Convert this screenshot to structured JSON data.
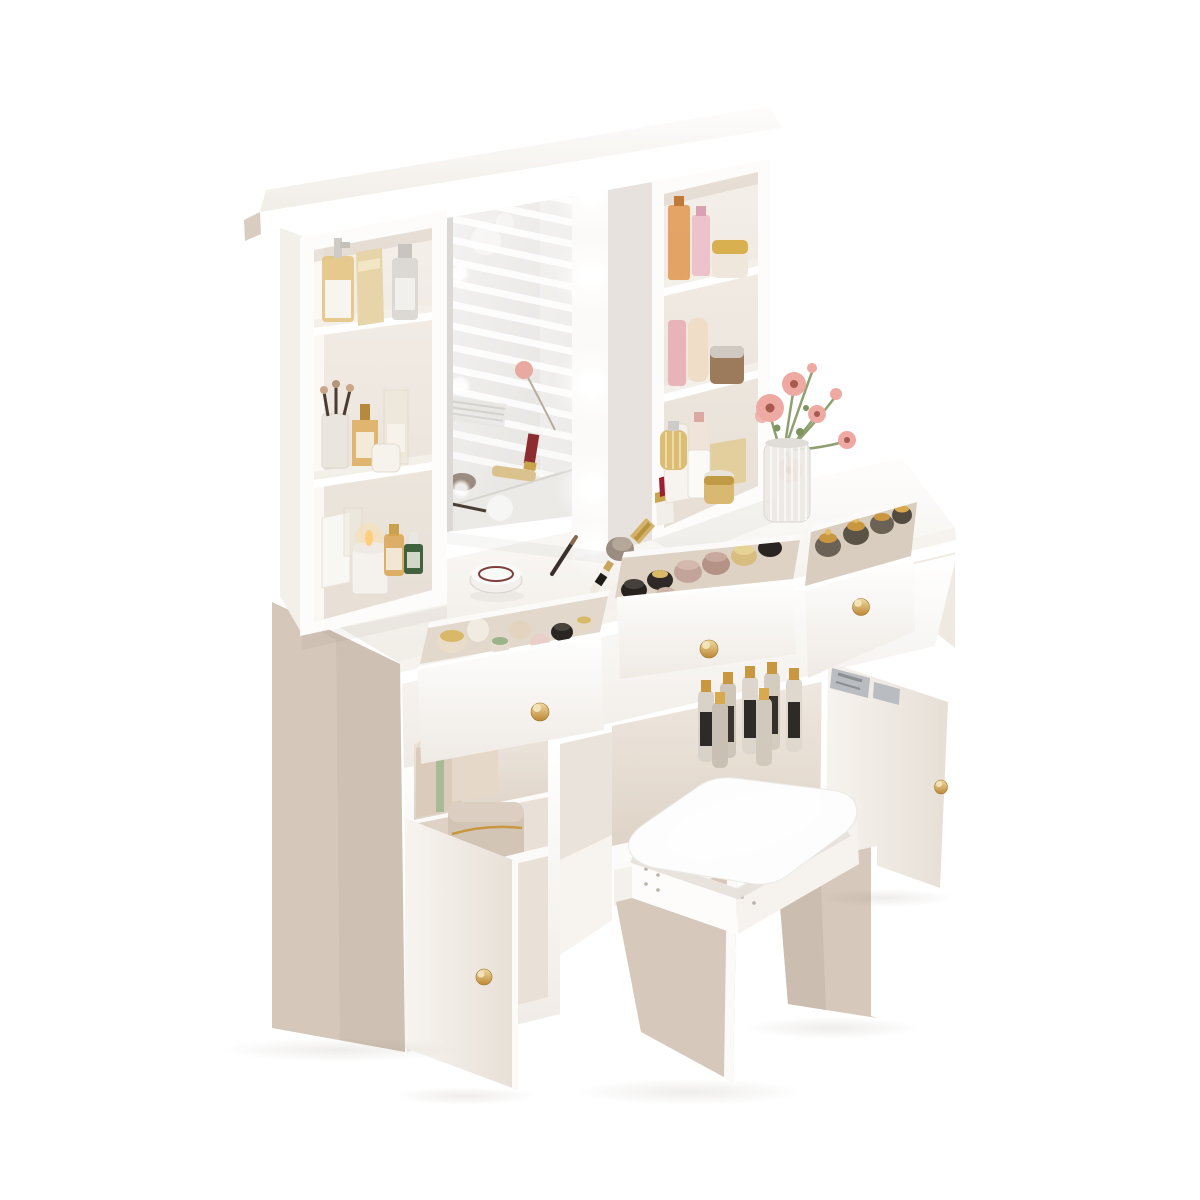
{
  "image_type": "product-photo",
  "subject": "White vanity dressing table set with lighted mirror hutch, open shelves, three open drawers with gold knobs, two open cabinet doors and a cushioned stool, styled with cosmetics and pink flowers on a pure white background",
  "background": "#ffffff",
  "palette": {
    "white": "#ffffff",
    "warm_white": "#f6f2ee",
    "side_beige": "#d5c8bb",
    "leg_beige": "#d6c9bc",
    "inset_beige": "#eae2d8",
    "gold": "#c8963e",
    "gold_light": "#ecd9a0",
    "mirror_gray": "#eceae7",
    "bulb_white": "#ffffff",
    "cushion_white": "#fdfdfd",
    "flower_pink": "#eeaaa2",
    "flower_center": "#a65a50",
    "leaf_green": "#7e9461",
    "lipstick_red": "#9e1f30",
    "amber": "#d9a552",
    "bottle_green": "#41623f",
    "hinge_silver": "#b9bcc0"
  },
  "structure": {
    "led_bulbs_visible": 5,
    "led_bulbs_reflected": 4,
    "drawers_open": 3,
    "cabinet_doors_open": 2,
    "hutch_left_compartments": 3,
    "hutch_right_compartments": 3,
    "stool_count": 1,
    "knob_finish": "gold",
    "mirror_reflection": "window blinds and tabletop cosmetics"
  },
  "hutch_items": {
    "left_top_shelf": [
      "amber pump bottle",
      "gold perfume box",
      "silver pump bottle"
    ],
    "left_middle_shelf": [
      "makeup brush cup",
      "gold perfume",
      "tall clear bottle",
      "white jar"
    ],
    "left_bottom_on_table": [
      "white box",
      "clear bottle",
      "lit candle",
      "gold serum",
      "green serum"
    ],
    "right_top_shelf": [
      "orange perfume",
      "pink perfume",
      "gold striped jar"
    ],
    "right_middle_shelf": [
      "pink slim bottle",
      "cream tube",
      "brown jar"
    ],
    "right_bottom_shelf": [
      "white bottle",
      "pink cap bottle",
      "gold box"
    ]
  },
  "tabletop_items": [
    "powder compact",
    "eyeliner pencil",
    "makeup brush",
    "gold lipstick",
    "red lipstick",
    "white box",
    "crinkled gold perfume",
    "white bottle",
    "gold jar",
    "ribbed glass vase with pink flowers"
  ],
  "drawer_contents": {
    "left": [
      "cream jars",
      "gold caps",
      "mint cap bottles",
      "black jar"
    ],
    "middle": [
      "black label jars",
      "mauve jars",
      "gold lid jars"
    ],
    "right": [
      "smoky glass jars with ornate gold lids"
    ]
  },
  "cabinet_contents": {
    "left_cubby": [
      "beige storage boxes with green strap"
    ],
    "left_door_compartment": [
      "round beige cosmetic case with gold zipper"
    ],
    "middle_compartment": [
      "gold and black perfume bottles"
    ]
  },
  "stool": {
    "cushion": "white upholstered cushion",
    "base": "white panel legs with beige faces"
  }
}
